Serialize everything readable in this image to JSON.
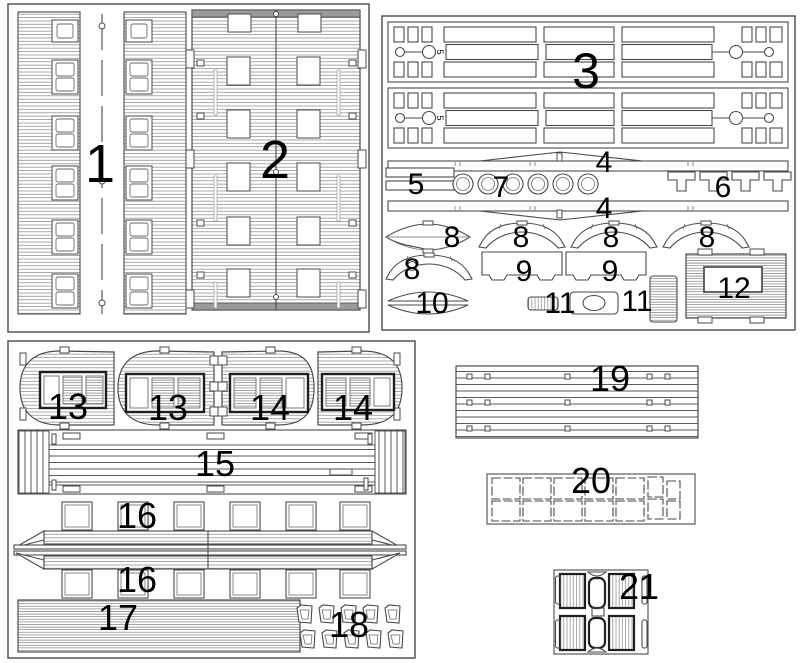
{
  "diagram": {
    "kind": "laser-cut parts sheet, line art, numbered parts",
    "background": "#ffffff",
    "line_color": "#4a4a4a",
    "hatch_color": "#8d8d8d",
    "frame_color": "#1f1f1f",
    "label_color": "#000000"
  },
  "labels": {
    "part1": "1",
    "part2": "2",
    "part3": "3",
    "part4_a": "4",
    "part4_b": "4",
    "part5": "5",
    "part6": "6",
    "part7": "7",
    "part8_a": "8",
    "part8_b": "8",
    "part8_c": "8",
    "part8_d": "8",
    "part8_e": "8",
    "part9_a": "9",
    "part9_b": "9",
    "part10": "10",
    "part11_a": "11",
    "part11_b": "11",
    "part12": "12",
    "part13_a": "13",
    "part13_b": "13",
    "part14_a": "14",
    "part14_b": "14",
    "part15": "15",
    "part16_a": "16",
    "part16_b": "16",
    "part17": "17",
    "part18": "18",
    "part19": "19",
    "part20": "20",
    "part21": "21",
    "strip_mark_a": "5",
    "strip_mark_b": "5"
  }
}
